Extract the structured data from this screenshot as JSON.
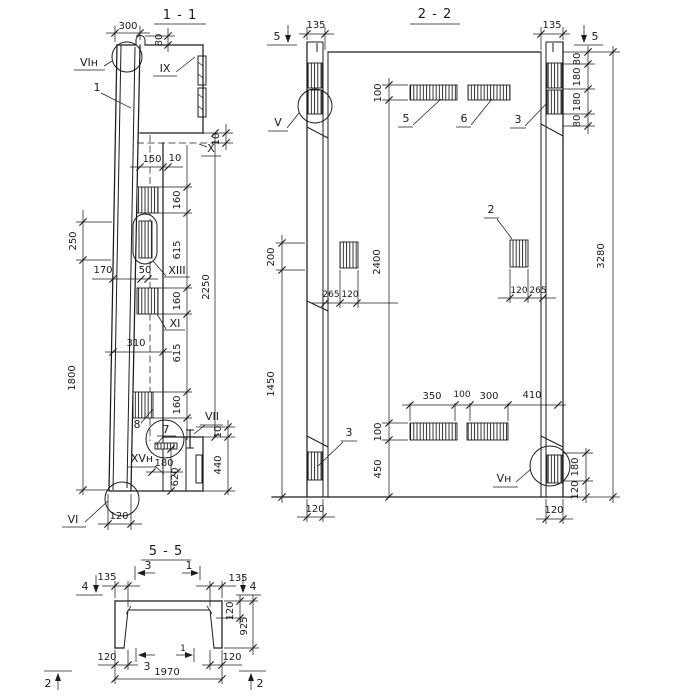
{
  "drawing": {
    "background": "#ffffff",
    "ink": "#1c1c1c"
  },
  "v11": {
    "title": "1 - 1",
    "dim_300": "300",
    "dim_80": "80",
    "label_vi_top": "VIн",
    "label_1": "1",
    "label_ix": "IX",
    "label_x": "X",
    "dim_10_top": "10",
    "dim_150": "150",
    "dim_10_mid": "10",
    "dim_250": "250",
    "dim_170": "170",
    "dim_50": "50",
    "dim_1800": "1800",
    "dim_160_a": "160",
    "dim_615_a": "615",
    "dim_160_b": "160",
    "dim_615_b": "615",
    "dim_160_c": "160",
    "dim_2250": "2250",
    "label_xiii": "XIII",
    "label_xi": "XI",
    "dim_310": "310",
    "label_8": "8",
    "label_7": "7",
    "label_vii": "VII",
    "dim_10_low": "10",
    "dim_440": "440",
    "label_xv": "XVн",
    "dim_180": "180",
    "dim_620": "620",
    "label_vi_bottom": "VI",
    "dim_120": "120"
  },
  "v22": {
    "title": "2 - 2",
    "cut_5_left": "5",
    "cut_5_right": "5",
    "dim_135_left": "135",
    "dim_135_right": "135",
    "dim_80_a": "80",
    "dim_180_a": "180",
    "dim_180_b": "180",
    "dim_80_b": "80",
    "dim_100_top": "100",
    "label_5": "5",
    "label_6": "6",
    "label_3_top": "3",
    "label_v": "V",
    "dim_200": "200",
    "dim_1450": "1450",
    "dim_2400": "2400",
    "dim_265_left": "265",
    "dim_120_left": "120",
    "label_2": "2",
    "dim_120_right": "120",
    "dim_265_right": "265",
    "dim_3280": "3280",
    "dim_350": "350",
    "dim_100_mid": "100",
    "dim_300": "300",
    "dim_410": "410",
    "dim_100_low": "100",
    "dim_450": "450",
    "label_3_bottom": "3",
    "label_vn": "Vн",
    "dim_180_low": "180",
    "dim_120_low": "120",
    "dim_120_footL": "120",
    "dim_120_footR": "120"
  },
  "v55": {
    "title": "5 - 5",
    "cut_4_left": "4",
    "cut_4_right": "4",
    "dim_135_left": "135",
    "dim_135_right": "135",
    "cut_3_top": "3",
    "cut_1_top": "1",
    "dim_120_side": "120",
    "dim_925": "925",
    "dim_120_botL": "120",
    "dim_120_botR": "120",
    "cut_3_bottom": "3",
    "cut_1_bottom": "1",
    "dim_1970": "1970",
    "cut_2_left": "2",
    "cut_2_right": "2"
  }
}
